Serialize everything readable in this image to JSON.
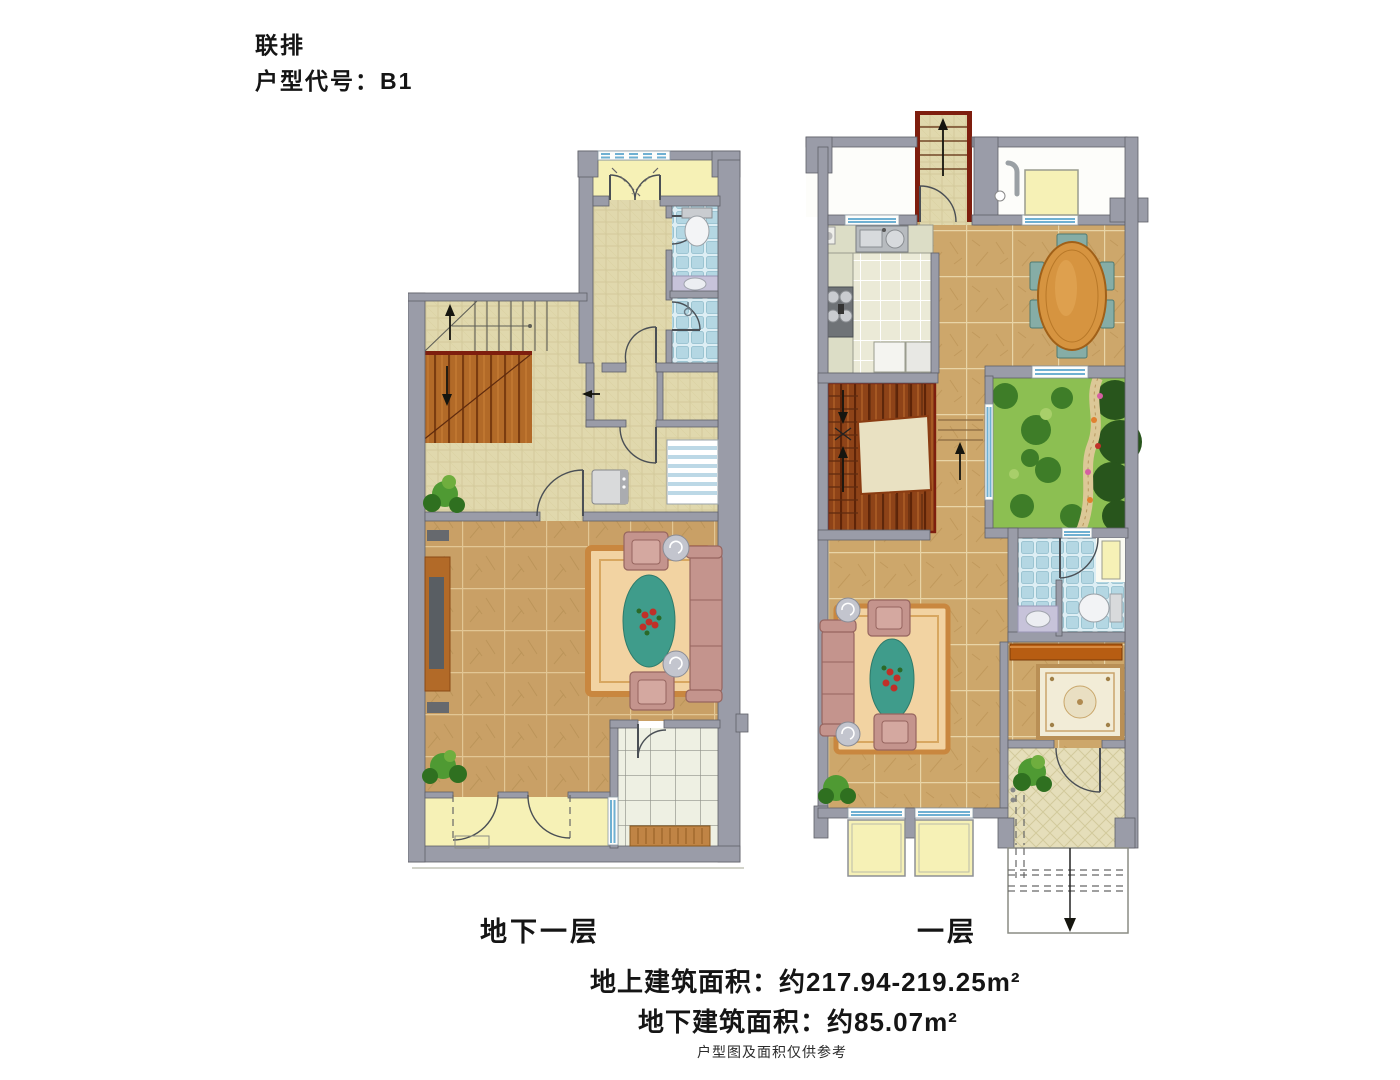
{
  "header": {
    "type_label": "联排",
    "code_label": "户型代号：B1"
  },
  "plans": {
    "basement": {
      "label": "地下一层"
    },
    "first": {
      "label": "一层"
    }
  },
  "footer": {
    "area_above": "地上建筑面积：约217.94-219.25m²",
    "area_below": "地下建筑面积：约85.07m²",
    "disclaimer": "户型图及面积仅供参考"
  },
  "palette": {
    "wall": "#9a9ca8",
    "wallLine": "#5f6068",
    "stairRed": "#7e1e0e",
    "tanTile": "#c9a066",
    "tanLine": "#e2c694",
    "marble": "#cda76b",
    "marbleLine": "#e8d4a6",
    "khaki": "#e0d8ad",
    "khakiLine": "#cdc493",
    "yellowRoom": "#f6f1b6",
    "blueTile": "#b4d7e3",
    "creamTile": "#ebead7",
    "patio": "#eef0e3",
    "entry": "#e5deba",
    "windowBlue": "#6fb0d2",
    "woodOrange": "#b26a28",
    "woodDark": "#8e4318",
    "gardenGrass": "#8cbf52",
    "gardenTree": "#3e7d28",
    "gardenDeep": "#28551c",
    "sofaPink": "#c4948d",
    "sofaLine": "#96655f",
    "rugField": "#f2d3a2",
    "rugBorder": "#c9873f",
    "rugTeal": "#3f9c8b",
    "rugCream": "#f2ecd7",
    "tableWood": "#d69440",
    "chairTeal": "#86ada6",
    "lavender": "#c7c3da",
    "cabinetOrange": "#b75d12",
    "plantGreen": "#4f9a33",
    "plantDark": "#2f7020",
    "benchWood": "#c08445"
  }
}
